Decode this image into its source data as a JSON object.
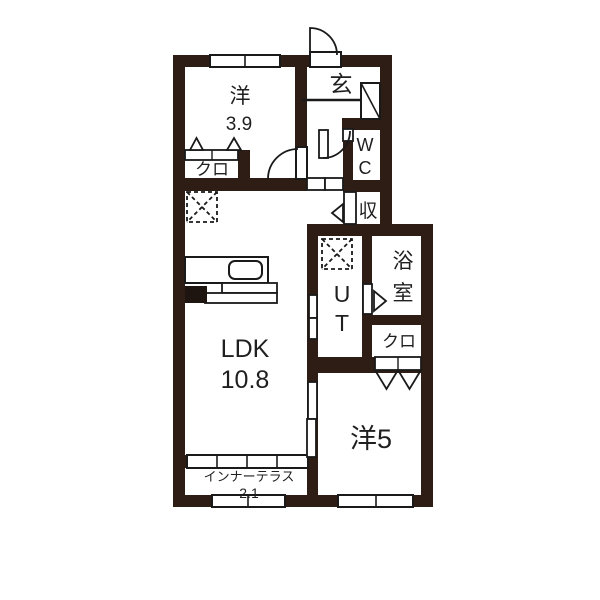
{
  "colors": {
    "wall": "#2e1d15",
    "line": "#1a1a1a",
    "background": "#ffffff",
    "text": "#1f1f1f"
  },
  "rooms": {
    "west_room_39": {
      "name": "洋",
      "area": "3.9"
    },
    "entrance": {
      "name": "玄"
    },
    "wc": {
      "line1": "W",
      "line2": "C"
    },
    "storage": {
      "name": "収"
    },
    "closet_upper": {
      "name": "クロ"
    },
    "ut": {
      "line1": "U",
      "line2": "T"
    },
    "bath": {
      "line1": "浴",
      "line2": "室"
    },
    "closet_right": {
      "name": "クロ"
    },
    "ldk": {
      "name": "LDK",
      "area": "10.8"
    },
    "west_room_5": {
      "name": "洋5"
    },
    "inner_terrace": {
      "name": "インナーテラス",
      "area": "2.1"
    }
  }
}
